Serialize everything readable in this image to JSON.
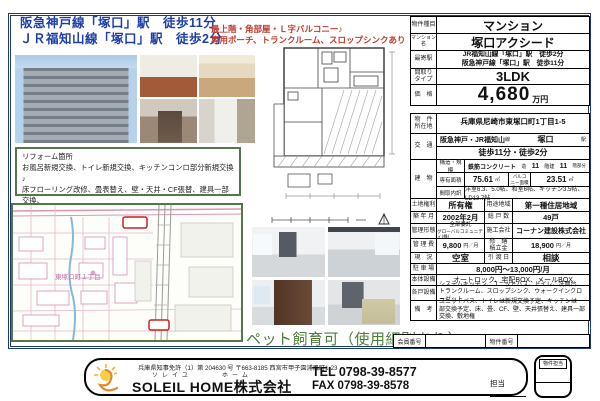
{
  "header": {
    "station_line1": "阪急神戸線「塚口」駅　徒歩11分",
    "station_line2": "ＪＲ福知山線「塚口」駅　徒歩2分",
    "highlight_line1": "最上階・角部屋・Ｌ字バルコニー♪",
    "highlight_line2": "専用ポーチ、トランクルーム、スロップシンクあり"
  },
  "reform_box": {
    "title": "リフォーム箇所",
    "line1": "お風呂新規交換、トイレ新規交換、キッチンコンロ部分新規交換♪",
    "line2": "床フローリング改修、畳表替え、壁・天井・CF張替、建具一部交換、",
    "line3": "カウンターキッチン♪"
  },
  "map": {
    "district_label": "東塚口町１丁目"
  },
  "pet_note": "ペット飼育可（使用細則あり）",
  "spec_top": {
    "type_label": "物件種目",
    "type_value": "マンション",
    "name_label": "マンション名",
    "name_value": "塚口アクシード",
    "station_label": "最寄駅",
    "station_value1": "JR福知山線「塚口」駅　徒歩2分",
    "station_value2": "阪急神戸線「塚口」駅　徒歩11分",
    "plan_label1": "間取り",
    "plan_label2": "タイプ",
    "plan_value": "3LDK",
    "price_label": "価　格",
    "price_value": "4,680",
    "price_unit": "万円"
  },
  "spec_main": {
    "address_label1": "物　件",
    "address_label2": "所在地",
    "address_value": "兵庫県尼崎市東塚口町1丁目1-5",
    "access_label": "交　通",
    "access_lines": "阪急神戸・JR福知山",
    "access_sen": "線",
    "access_station": "塚口",
    "access_eki": "駅",
    "access_walk": "徒歩11分・徒歩2分",
    "building_label": "建　物",
    "structure_label": "構造・規模",
    "structure_value": "鉄筋コンクリート",
    "structure_unit1": "造",
    "structure_floors": "11",
    "structure_unit2": "階建",
    "structure_floor": "11",
    "structure_unit3": "階部分",
    "area_label": "専有面積",
    "area_value": "75.61",
    "area_unit": "㎡",
    "balcony_label1": "バルコ",
    "balcony_label2": "ニー面積",
    "balcony_value": "23.51",
    "balcony_unit": "㎡",
    "layout_label": "間取内訳",
    "layout_value": "洋室6.3、5.0帖、和室6帖、キッチン3.5帖、LD13.7帖",
    "land_label": "土地権利",
    "land_value": "所有権",
    "zoning_label": "用途地域",
    "zoning_value": "第一種住居地域",
    "built_label": "築 年 月",
    "built_value": "2002年2月",
    "units_label": "総 戸 数",
    "units_value": "49戸",
    "mgmt_label": "管理形態",
    "mgmt_value1": "全部委託",
    "mgmt_value2": "グローバルコミュニティ(株)",
    "builder_label": "施工会社",
    "builder_value": "コーナン建設株式会社",
    "fee_label": "管 理 費",
    "fee_value": "9,800",
    "fee_unit": "円／月",
    "reserve_label1": "修　繕",
    "reserve_label2": "積立金",
    "reserve_value": "18,900",
    "reserve_unit": "円／月",
    "status_label": "現　況",
    "status_value": "空室",
    "handover_label": "引 渡 日",
    "handover_value": "相談",
    "parking_label": "駐 車 場",
    "parking_value": "8,000円～13,000円/月",
    "facility_label": "本体設備",
    "facility_value": "オートロック、宅配BOX、メールBOX",
    "unit_facility_label": "各戸設備",
    "unit_facility_value": "システムキッチン、ユニットバス、トイレ、洗面台、トランクルーム、スロップシンク、ウォークインクローゼット",
    "notes_label": "備　考",
    "notes_value": "ユニットバス、トイレは新規交換予定、キッチンは一部交換予定、床、畳、CF、壁、天井張替え、建具一部交換、敷地権",
    "member_no_label": "会員番号",
    "property_no_label": "物件番号"
  },
  "footer": {
    "license": "兵庫県知事免許（1）第 204630 号",
    "address": "〒663-8185 西宮市甲子園浦風町1-23",
    "furigana_soleil": "ソレイユ",
    "furigana_home": "ホーム",
    "company": "SOLEIL HOME株式会社",
    "tel": "TEL 0798-39-8577",
    "fax": "FAX 0798-39-8578",
    "staff_label": "担当",
    "stamp_label": "物件担当"
  },
  "colors": {
    "frame_blue": "#1c3a6e",
    "station_blue": "#1d3ea8",
    "highlight_red": "#bf3a2c",
    "reform_green": "#57754d",
    "pet_green": "#4e7d3a"
  }
}
